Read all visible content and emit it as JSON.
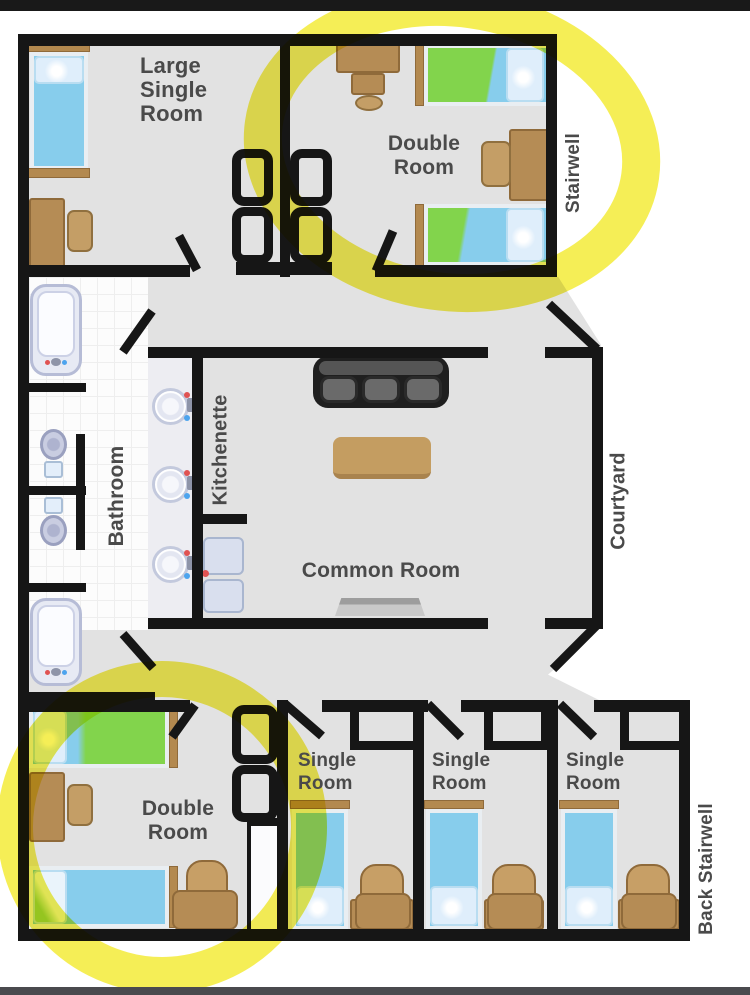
{
  "labels": {
    "large_single_room": {
      "lines": [
        "Large",
        "Single",
        "Room"
      ]
    },
    "double_room_top": {
      "lines": [
        "Double",
        "Room"
      ]
    },
    "stairwell": "Stairwell",
    "bathroom": "Bathroom",
    "kitchenette": "Kitchenette",
    "common_room": "Common Room",
    "courtyard": "Courtyard",
    "double_room_bottom": {
      "lines": [
        "Double",
        "Room"
      ]
    },
    "single_room_1": {
      "lines": [
        "Single",
        "Room"
      ]
    },
    "single_room_2": {
      "lines": [
        "Single",
        "Room"
      ]
    },
    "single_room_3": {
      "lines": [
        "Single",
        "Room"
      ]
    },
    "back_stairwell": "Back Stairwell"
  },
  "colors": {
    "wall": "#161616",
    "floor": "#e2e2e2",
    "bathroom_tile": "#fcfcfc",
    "highlight_marker": "#f3eb38",
    "bed_blue": "#87cdec",
    "bed_green_highlighted": "#82d44c",
    "furniture_wood": "#b58c55",
    "sofa_gray": "#1f1f1f",
    "label_text": "#4a4a4a"
  }
}
